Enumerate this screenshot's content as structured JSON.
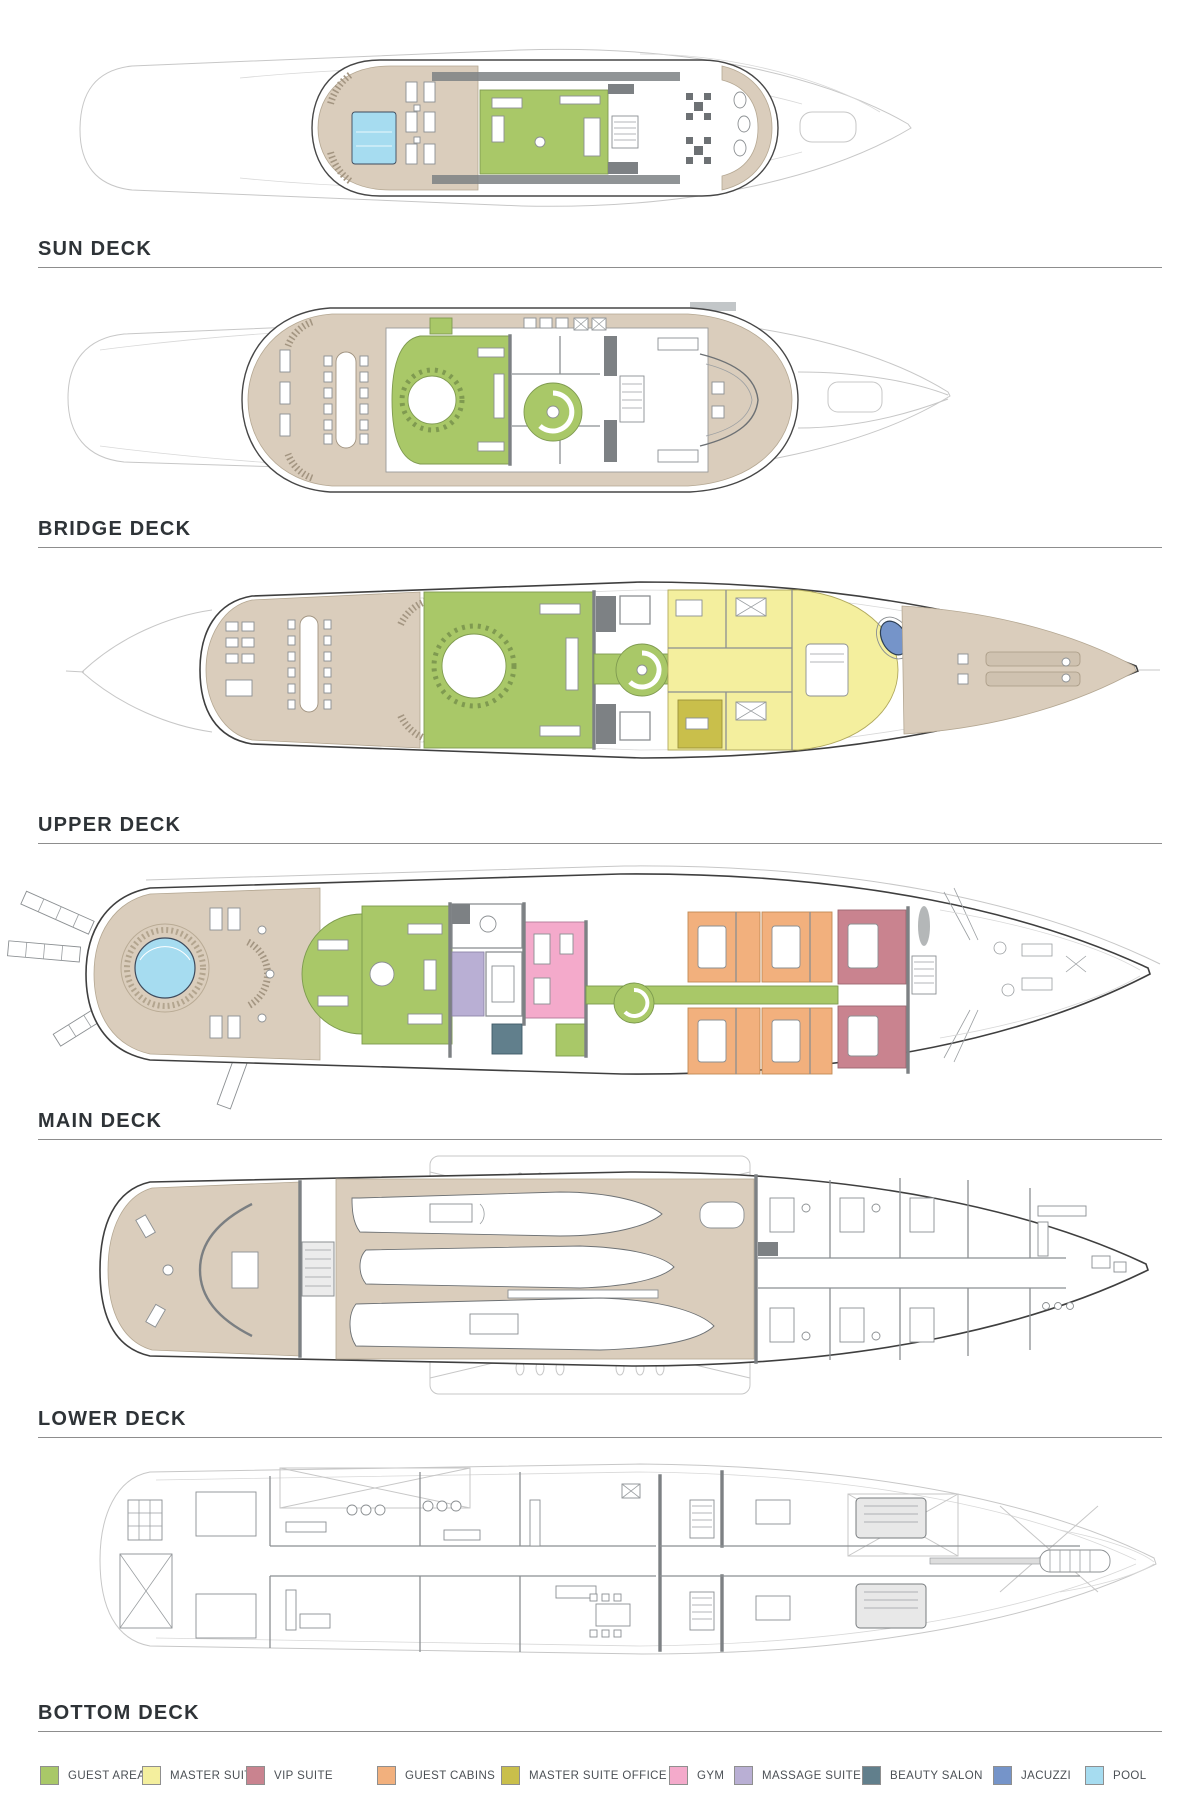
{
  "decks": [
    {
      "id": "sun",
      "label": "SUN DECK"
    },
    {
      "id": "bridge",
      "label": "BRIDGE DECK"
    },
    {
      "id": "upper",
      "label": "UPPER DECK"
    },
    {
      "id": "main",
      "label": "MAIN DECK"
    },
    {
      "id": "lower",
      "label": "LOWER DECK"
    },
    {
      "id": "bottom",
      "label": "BOTTOM DECK"
    }
  ],
  "legend": {
    "items": [
      {
        "label": "GUEST AREAS",
        "color": "#a9c868"
      },
      {
        "label": "MASTER SUITE",
        "color": "#f4ef9e"
      },
      {
        "label": "VIP SUITE",
        "color": "#c9838f"
      },
      {
        "label": "GUEST CABINS",
        "color": "#f2b07d"
      },
      {
        "label": "MASTER SUITE OFFICE",
        "color": "#c9bf4b"
      },
      {
        "label": "GYM",
        "color": "#f4aacb"
      },
      {
        "label": "MASSAGE SUITE",
        "color": "#b9afd4"
      },
      {
        "label": "BEAUTY SALON",
        "color": "#617f8c"
      },
      {
        "label": "JACUZZI",
        "color": "#7594c9"
      },
      {
        "label": "POOL",
        "color": "#a6dcf0"
      }
    ]
  }
}
